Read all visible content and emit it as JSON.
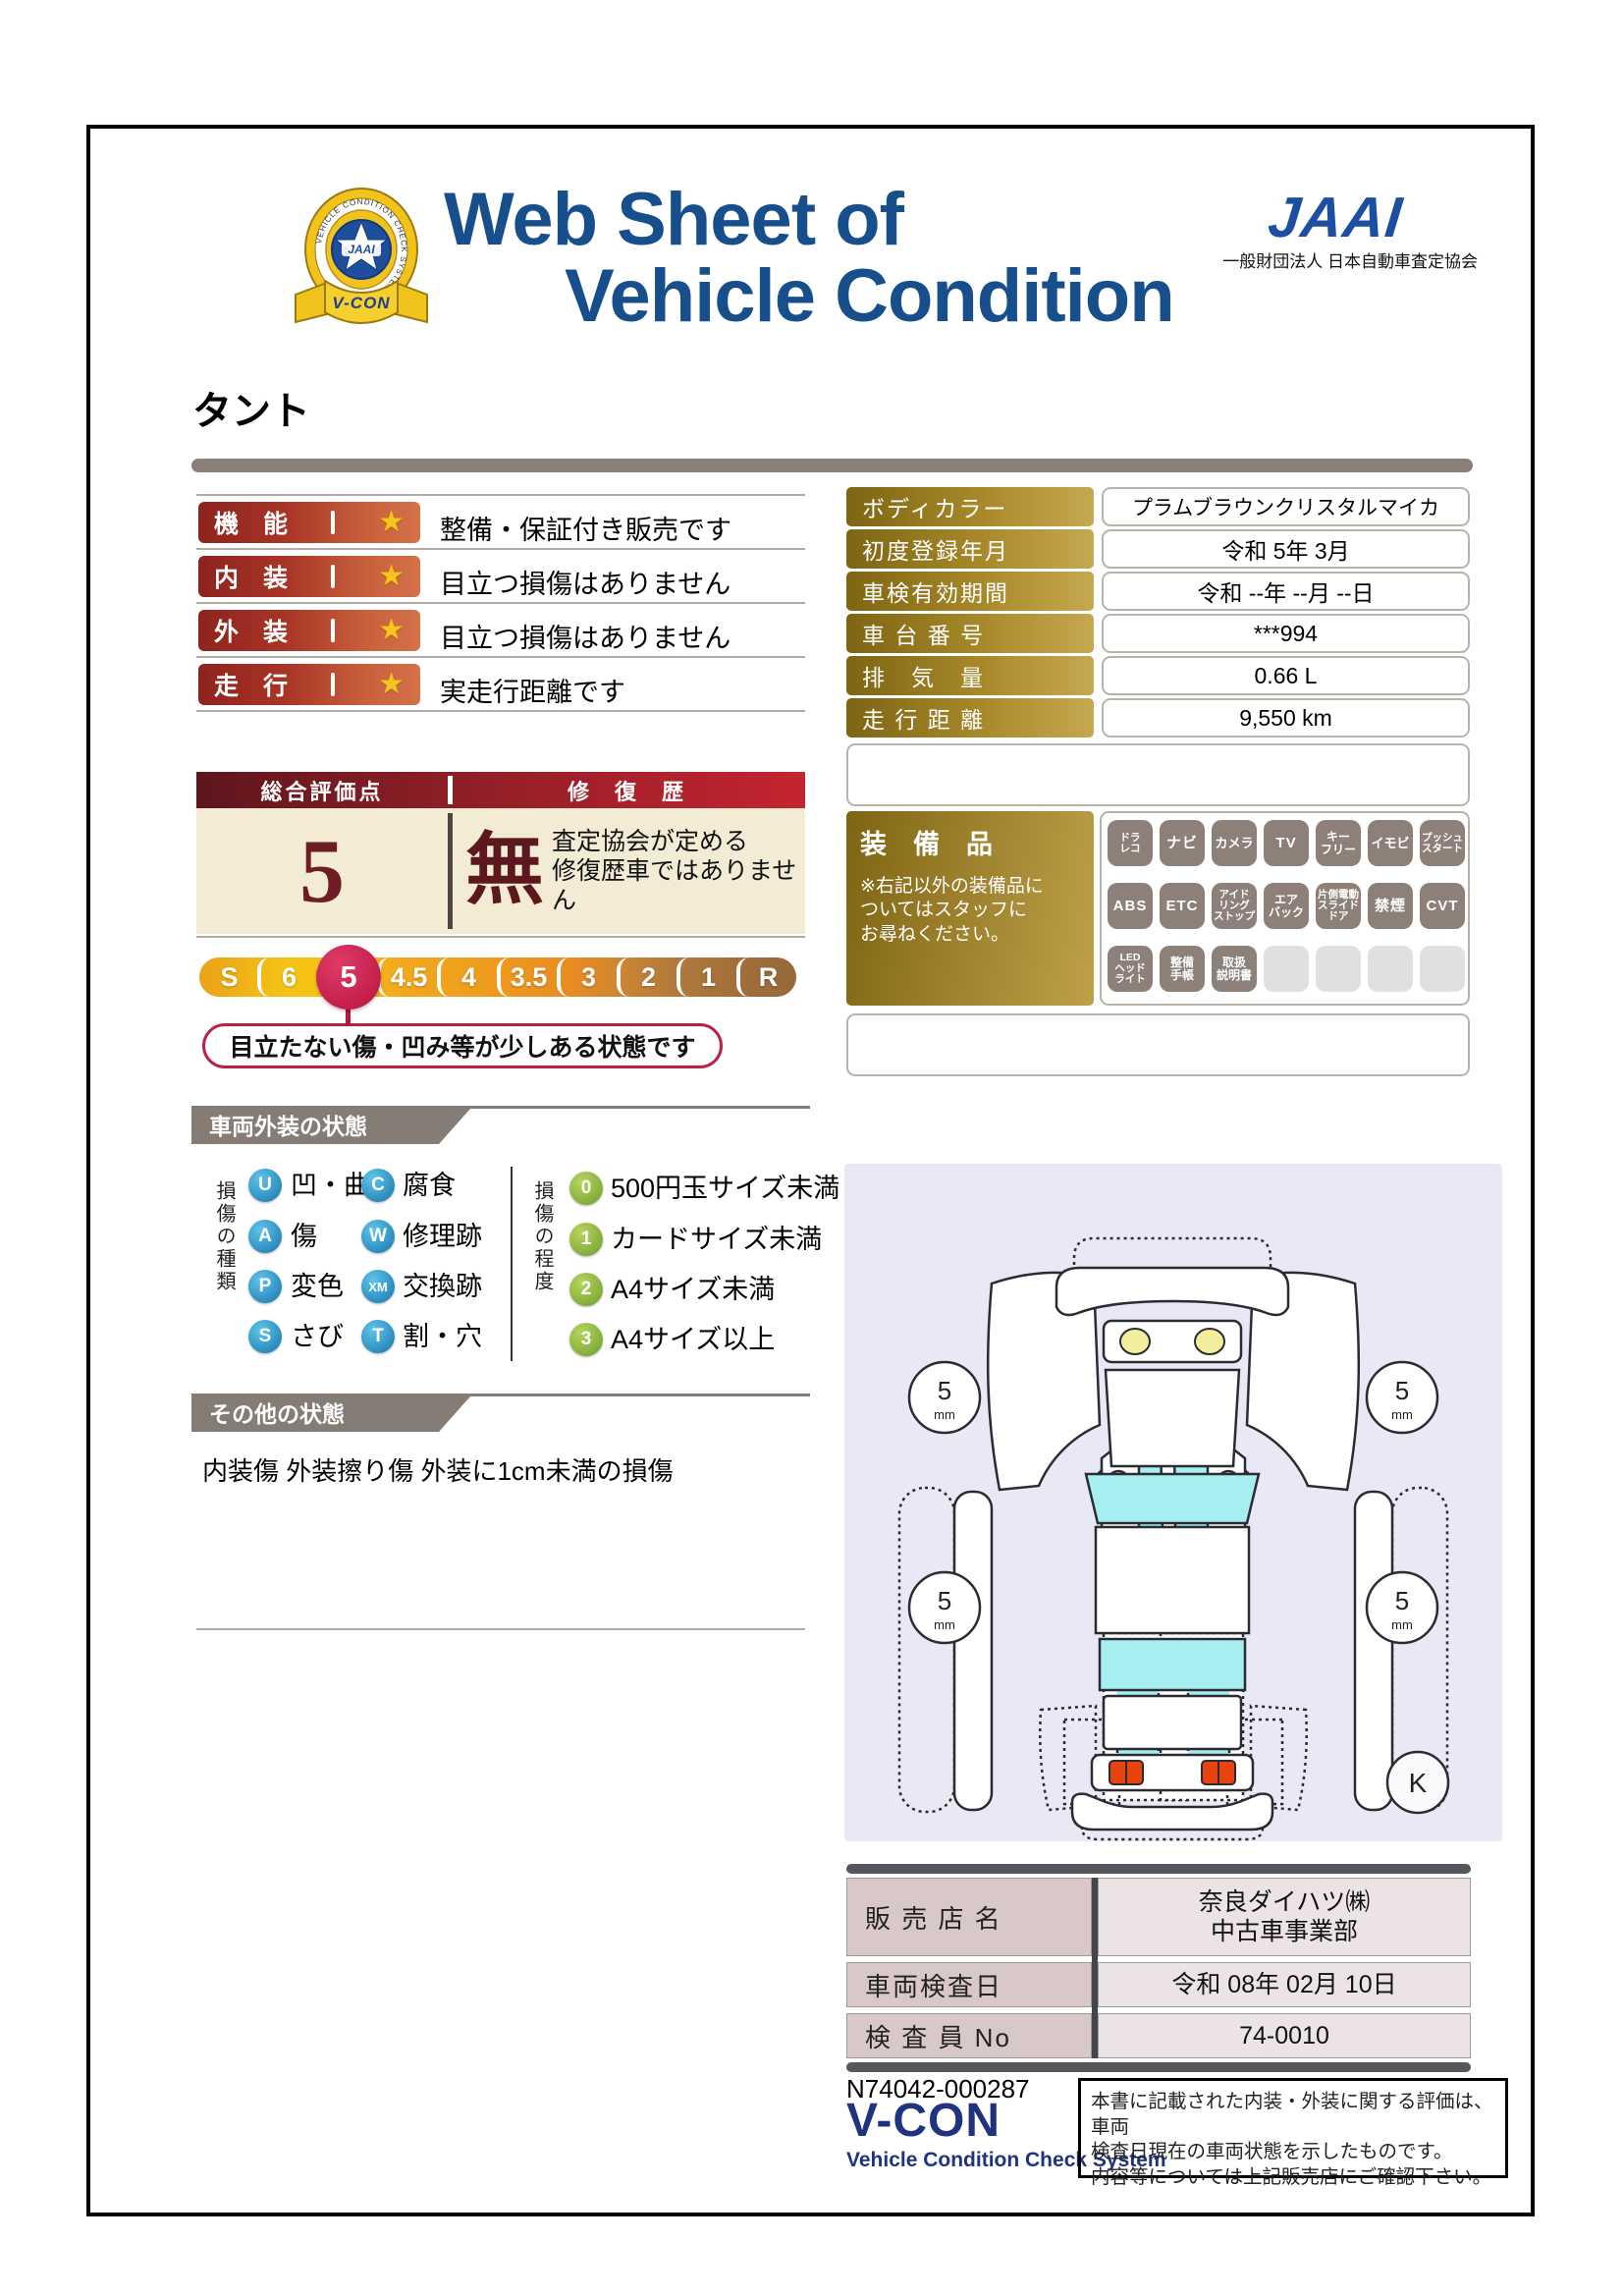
{
  "colors": {
    "title_blue": "#174e8c",
    "logo_blue": "#1c4fa2",
    "maroon": "#6e1d24",
    "crimson": "#bb2148",
    "gold": "#a8892a",
    "banner_gray": "#867c76",
    "bar_red": "#8e231f",
    "star_gold": "#f6c41d"
  },
  "header": {
    "title_line1": "Web Sheet of",
    "title_line2": "Vehicle Condition",
    "emblem": {
      "ring_text": "VEHICLE CONDITION CHECK SYSTEM",
      "badge_text": "JAAI",
      "ribbon_text": "V-CON"
    },
    "jaai_wordmark": "JAAI",
    "jaai_org": "一般財団法人 日本自動車査定協会"
  },
  "vehicle_name": "タント",
  "star_glyph": "★",
  "ratings": [
    {
      "label": "機　能",
      "comment": "整備・保証付き販売です"
    },
    {
      "label": "内　装",
      "comment": "目立つ損傷はありません"
    },
    {
      "label": "外　装",
      "comment": "目立つ損傷はありません"
    },
    {
      "label": "走　行",
      "comment": "実走行距離です"
    }
  ],
  "info_table": [
    {
      "label": "ボディカラー",
      "value": "プラムブラウンクリスタルマイカ"
    },
    {
      "label": "初度登録年月",
      "value": "令和 5年 3月"
    },
    {
      "label": "車検有効期間",
      "value": "令和 --年 --月 --日"
    },
    {
      "label": "車 台 番 号",
      "value": "***994"
    },
    {
      "label": "排　気　量",
      "value": "0.66 L"
    },
    {
      "label": "走 行 距 離",
      "value": "9,550 km"
    }
  ],
  "overall": {
    "header_left": "総合評価点",
    "header_right": "修　復　歴",
    "score": "5",
    "repair_status": "無",
    "repair_note": "査定協会が定める\n修復歴車ではありません"
  },
  "scale": {
    "items": [
      "S",
      "6",
      "5",
      "4.5",
      "4",
      "3.5",
      "3",
      "2",
      "1",
      "R"
    ],
    "selected": "5",
    "callout": "目立たない傷・凹み等が少しある状態です"
  },
  "equipment": {
    "title": "装　備　品",
    "note": "※右記以外の装備品に\nついてはスタッフに\nお尋ねください。",
    "rows": [
      [
        "ドラ\nレコ",
        "ナビ",
        "カメラ",
        "TV",
        "キー\nフリー",
        "イモビ",
        "プッシュ\nスタート"
      ],
      [
        "ABS",
        "ETC",
        "アイド\nリング\nストップ",
        "エア\nバック",
        "片側電動\nスライド\nドア",
        "禁煙",
        "CVT"
      ],
      [
        "LED\nヘッド\nライト",
        "整備\n手帳",
        "取扱\n説明書",
        "",
        "",
        "",
        ""
      ]
    ]
  },
  "exterior": {
    "title": "車両外装の状態",
    "type_axis": "損傷の種類",
    "degree_axis": "損傷の程度",
    "types": [
      {
        "code": "U",
        "label": "凹・曲"
      },
      {
        "code": "A",
        "label": "傷"
      },
      {
        "code": "P",
        "label": "変色"
      },
      {
        "code": "S",
        "label": "さび"
      },
      {
        "code": "C",
        "label": "腐食"
      },
      {
        "code": "W",
        "label": "修理跡"
      },
      {
        "code": "XM",
        "label": "交換跡"
      },
      {
        "code": "T",
        "label": "割・穴"
      }
    ],
    "degrees": [
      {
        "code": "0",
        "label": "500円玉サイズ未満"
      },
      {
        "code": "1",
        "label": "カードサイズ未満"
      },
      {
        "code": "2",
        "label": "A4サイズ未満"
      },
      {
        "code": "3",
        "label": "A4サイズ以上"
      }
    ]
  },
  "other": {
    "title": "その他の状態",
    "text": "内装傷 外装擦り傷 外装に1cm未満の損傷"
  },
  "diagram": {
    "tread_value": "5",
    "tread_unit": "mm",
    "corner_mark": "K"
  },
  "dealer_table": [
    {
      "label": "販 売 店 名",
      "value": "奈良ダイハツ㈱\n中古車事業部"
    },
    {
      "label": "車両検査日",
      "value": "令和 08年 02月 10日"
    },
    {
      "label": "検 査 員 No",
      "value": "74-0010"
    }
  ],
  "footer": {
    "doc_no": "N74042-000287",
    "vcon": "V-CON",
    "vcon_sub": "Vehicle Condition Check System",
    "disclaimer": "本書に記載された内装・外装に関する評価は、車両\n検査日現在の車両状態を示したものです。\n内容等については上記販売店にご確認下さい。"
  }
}
